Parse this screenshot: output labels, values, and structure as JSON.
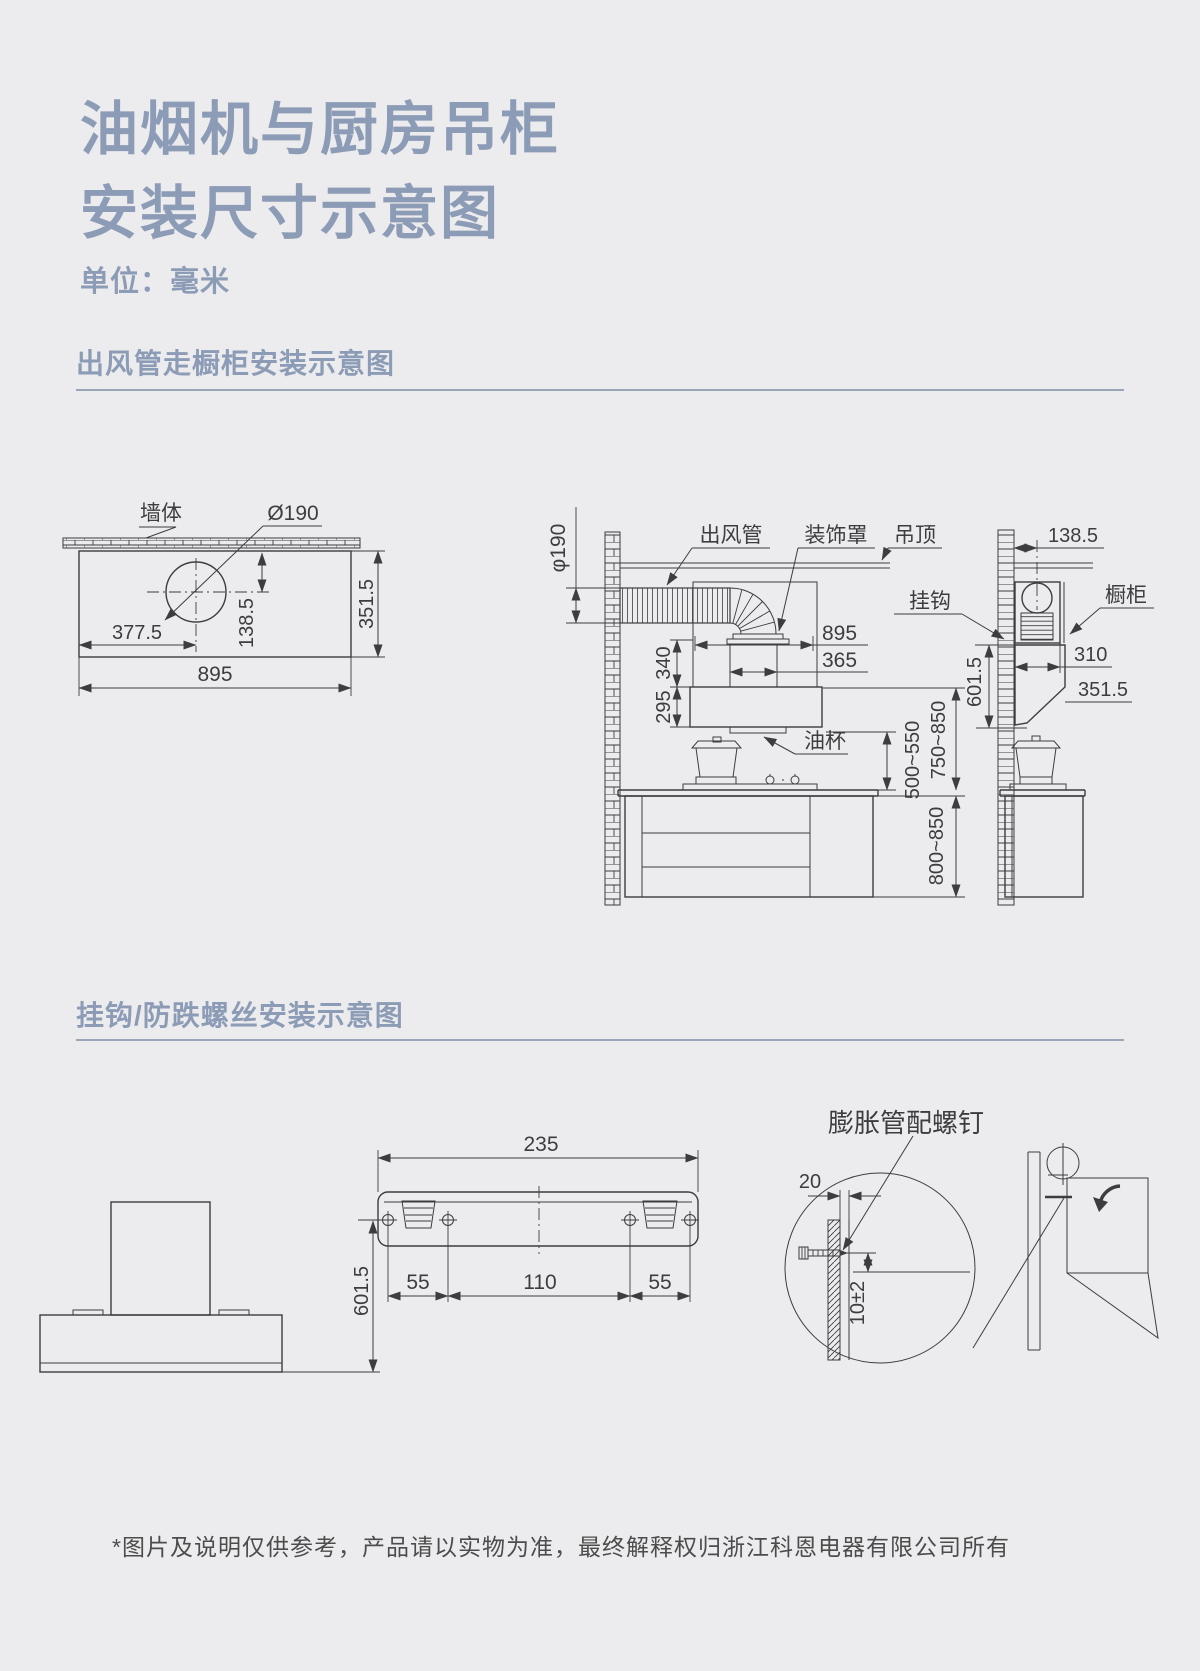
{
  "page": {
    "bg": "#ececee",
    "accent": "#8d9cb6",
    "rule": "#9aa5ba",
    "ink": "#3d3d41",
    "footer_color": "#4c4c4c"
  },
  "title": {
    "line1": "油烟机与厨房吊柜",
    "line2": "安装尺寸示意图"
  },
  "unit_label": "单位：毫米",
  "section1": {
    "heading": "出风管走橱柜安装示意图"
  },
  "section2": {
    "heading": "挂钩/防跌螺丝安装示意图"
  },
  "diagram1": {
    "top_view": {
      "wall": "墙体",
      "hole": "Ø190",
      "left": "377.5",
      "top": "138.5",
      "side": "351.5",
      "width": "895"
    },
    "side_view": {
      "duct_dia": "φ190",
      "duct": "出风管",
      "cover": "装饰罩",
      "ceiling": "吊顶",
      "width": "895",
      "outlet": "365",
      "upper_h": "340",
      "lower_h": "295",
      "oilcup": "油杯",
      "hood_to_counter": "500~550",
      "mid_to_counter": "750~850",
      "counter_h": "800~850"
    },
    "wall_view": {
      "wall_to_center": "138.5",
      "hook": "挂钩",
      "cabinet": "橱柜",
      "cab_width": "310",
      "depth": "351.5",
      "hook_height": "601.5"
    }
  },
  "diagram2": {
    "front": {
      "height": "601.5"
    },
    "bracket": {
      "width": "235",
      "left": "55",
      "middle": "110",
      "right": "55"
    },
    "detail": {
      "anchor": "膨胀管配螺钉",
      "embed": "20",
      "offset": "10±2"
    }
  },
  "footer": "*图片及说明仅供参考，产品请以实物为准，最终解释权归浙江科恩电器有限公司所有"
}
